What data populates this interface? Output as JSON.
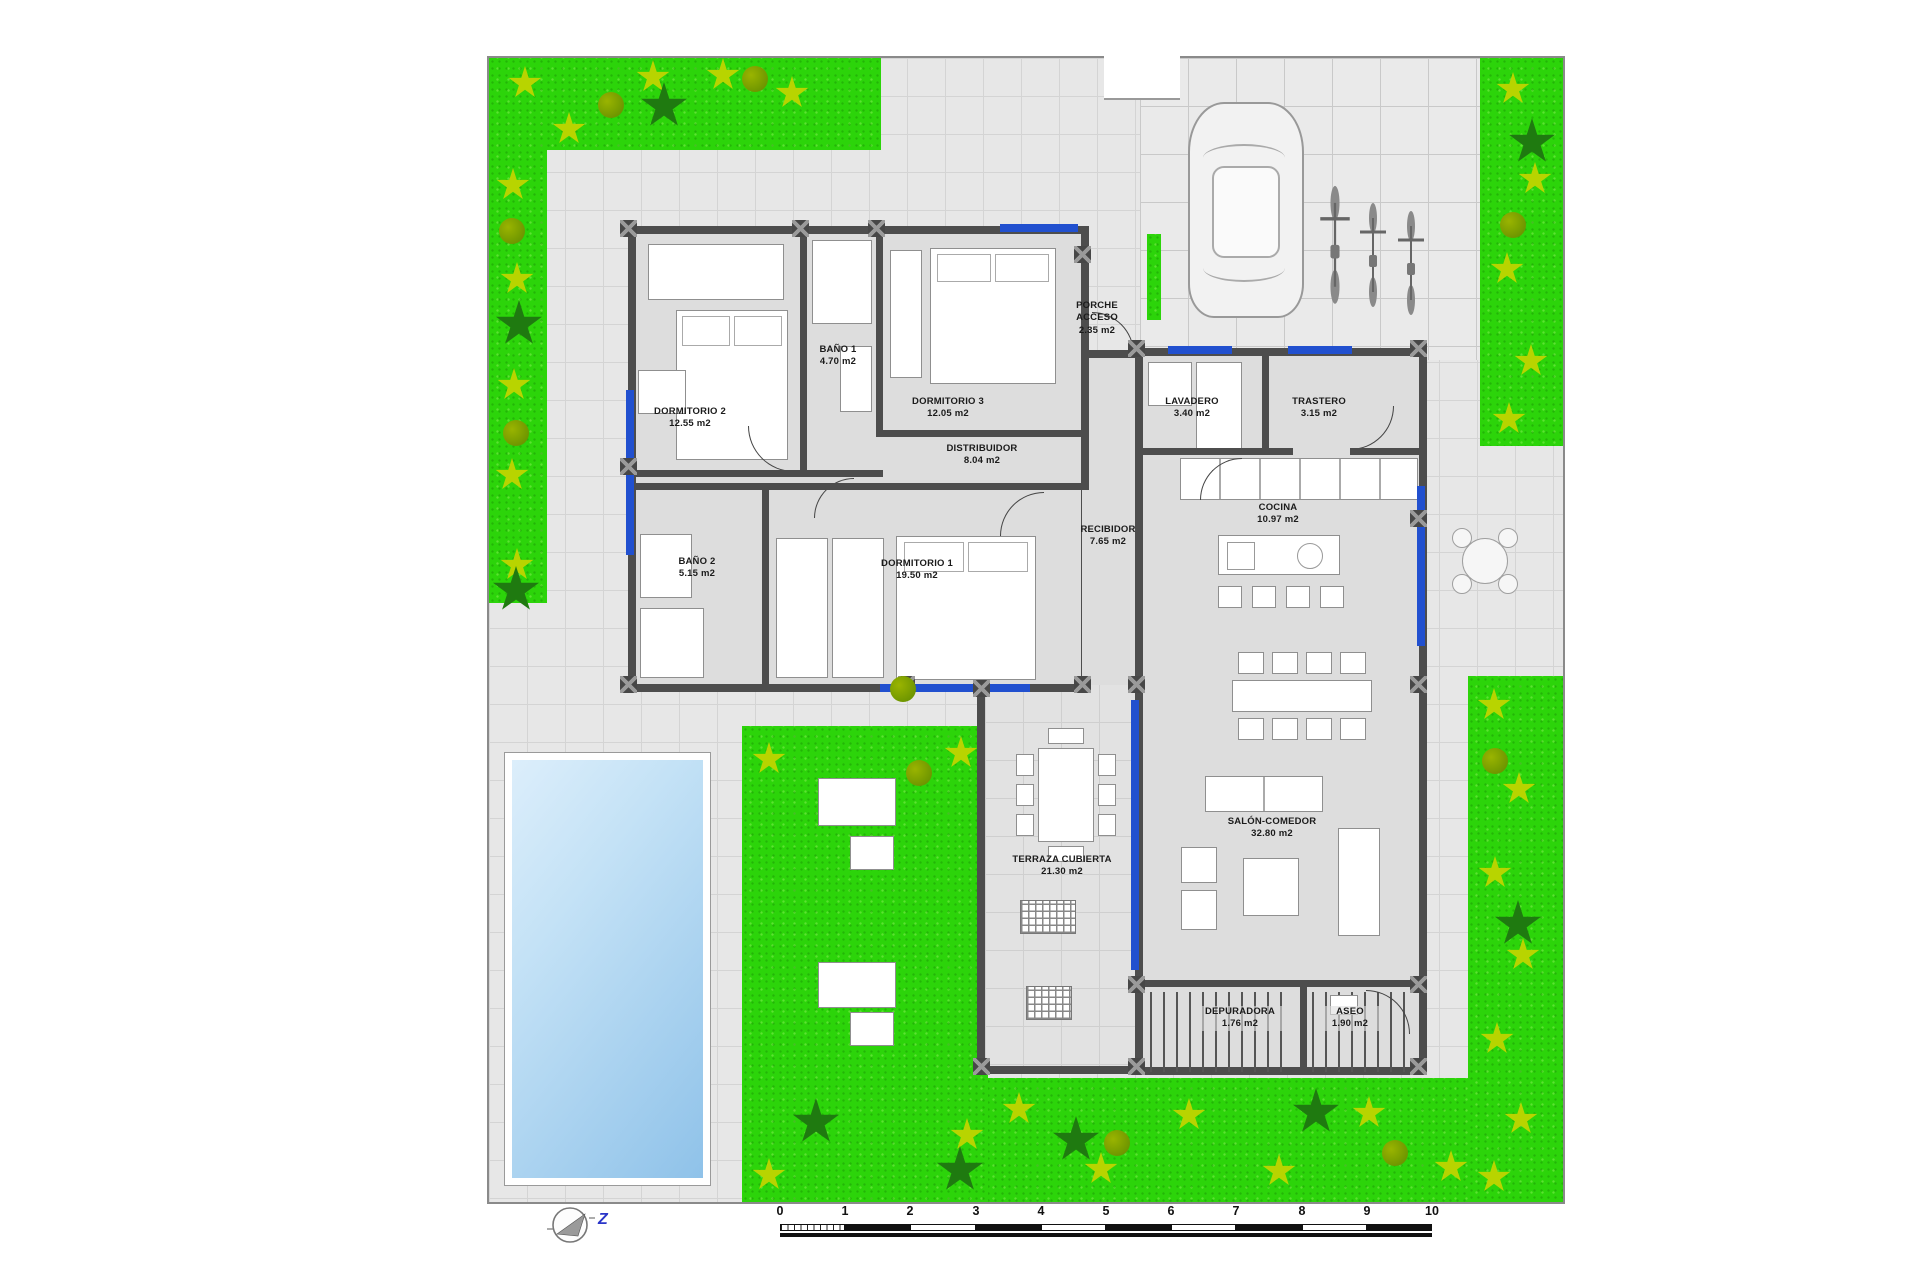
{
  "rooms": [
    {
      "name": "DORMITORIO 2",
      "area": "12.55 m2"
    },
    {
      "name": "BAÑO 1",
      "area": "4.70 m2"
    },
    {
      "name": "DORMITORIO 3",
      "area": "12.05 m2"
    },
    {
      "name": "DISTRIBUIDOR",
      "area": "8.04 m2"
    },
    {
      "name": "RECIBIDOR",
      "area": "7.65 m2"
    },
    {
      "name": "BAÑO 2",
      "area": "5.15 m2"
    },
    {
      "name": "DORMITORIO 1",
      "area": "19.50 m2"
    },
    {
      "name": "PORCHE ACCESO",
      "area": "2.35 m2"
    },
    {
      "name": "LAVADERO",
      "area": "3.40 m2"
    },
    {
      "name": "TRASTERO",
      "area": "3.15 m2"
    },
    {
      "name": "COCINA",
      "area": "10.97 m2"
    },
    {
      "name": "SALÓN-COMEDOR",
      "area": "32.80 m2"
    },
    {
      "name": "TERRAZA CUBIERTA",
      "area": "21.30 m2"
    },
    {
      "name": "DEPURADORA",
      "area": "1.76 m2"
    },
    {
      "name": "ASEO",
      "area": "1.90 m2"
    }
  ],
  "scale_bar": {
    "labels": [
      "0",
      "1",
      "2",
      "3",
      "4",
      "5",
      "6",
      "7",
      "8",
      "9",
      "10"
    ]
  },
  "compass": {
    "label": "Z"
  },
  "colors": {
    "grass": "#2cd40a",
    "plant_yellow": "#b8d400",
    "palm_green": "#1f7a10",
    "wall": "#4d4d4d",
    "window_blue": "#2150cf",
    "pool_blue": "#8fc2e9",
    "tile_gray": "#e7e7e7",
    "compass_letter_blue": "#2a35c8"
  }
}
